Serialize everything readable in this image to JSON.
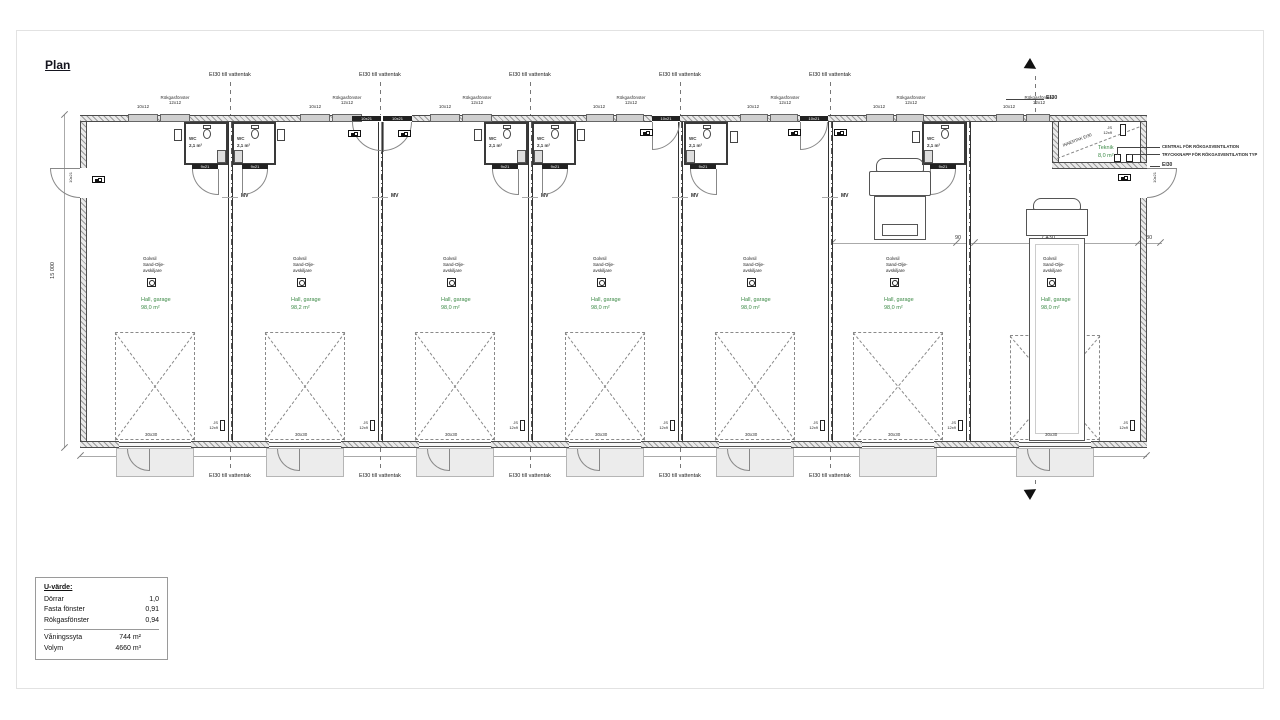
{
  "title": "Plan",
  "labels": {
    "ei30_vattentak": "EI30 till vattentak",
    "ei30": "EI30",
    "mv": "MV",
    "wc": "WC",
    "wc_area": "2,1 m²",
    "door_wc": "9x21",
    "door_entry": "10x21",
    "window_small": "10x12",
    "rokgas_name": "Rökgasfönster",
    "rokgas_size": "12x12",
    "js_name": "JS",
    "js_size": "12x9",
    "garage_door": "30x30"
  },
  "drain": {
    "line1": "Golvsil",
    "line2": "Sand-Olje-",
    "line3": "avskiljare"
  },
  "hall_label": "Hall, garage",
  "unit_areas": [
    "98,0 m²",
    "98,2 m²",
    "98,0 m²",
    "98,0 m²",
    "98,0 m²",
    "98,0 m²",
    "98,0 m²"
  ],
  "teknik": {
    "name": "Teknik",
    "area": "8,0 m²",
    "ceiling": "INNERTAK EI30",
    "callout_central": "CENTRAL FÖR RÖKGASVENTILATION",
    "callout_button": "TRYCKKNAPP FÖR RÖKGASVENTILATION TYP"
  },
  "dimensions": {
    "building_height": "15 000",
    "building_length": "49 310",
    "bay6_width": "6 830",
    "bay6_wall": "90",
    "bay7_width": "7 430",
    "bay7_wall": "180"
  },
  "legend": {
    "title": "U-värde:",
    "rows": [
      {
        "label": "Dörrar",
        "value": "1,0"
      },
      {
        "label": "Fasta fönster",
        "value": "0,91"
      },
      {
        "label": "Rökgasfönster",
        "value": "0,94"
      }
    ],
    "area_label": "Våningssyta",
    "area_value": "744 m²",
    "volume_label": "Volym",
    "volume_value": "4660 m³"
  }
}
